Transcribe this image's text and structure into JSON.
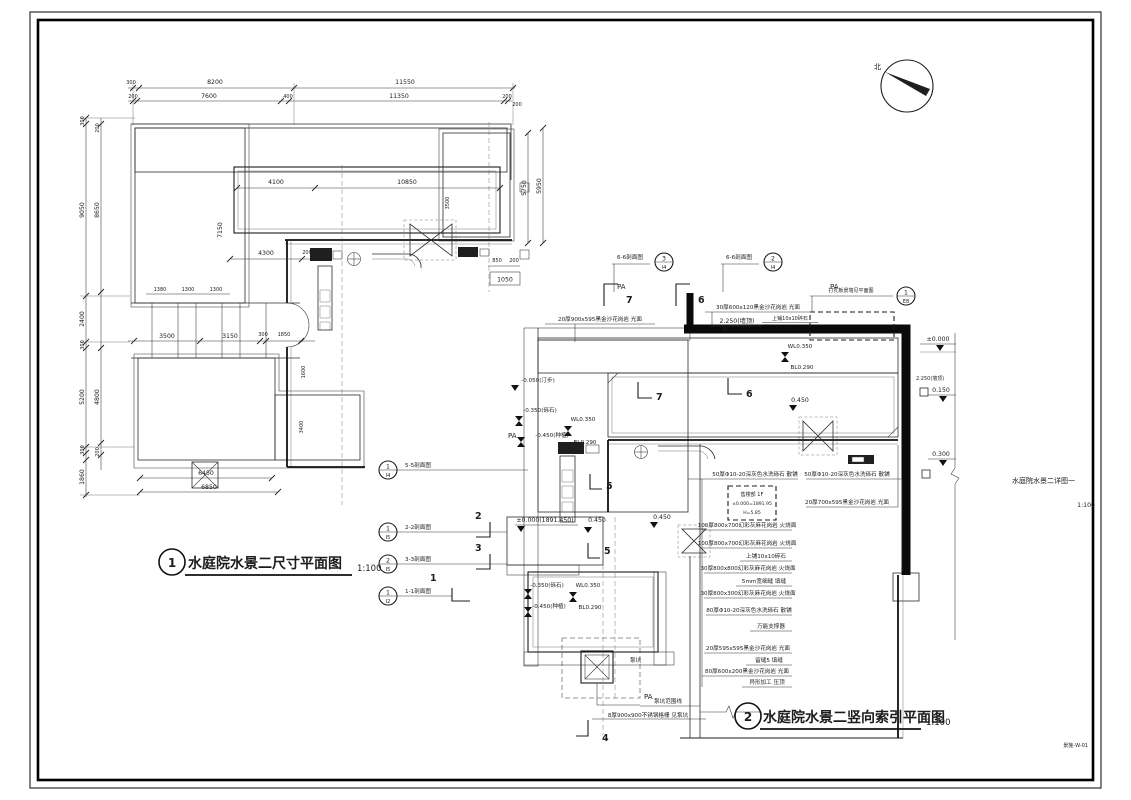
{
  "page": {
    "north": "北",
    "side_title": "水庭院水景二详图一",
    "side_scale": "1:100",
    "sheet_no": "景施-W-01"
  },
  "plan1": {
    "number": "1",
    "title": "水庭院水景二尺寸平面图",
    "scale": "1:100",
    "dims": {
      "t1a": "300",
      "t1b": "8200",
      "t1c": "11550",
      "t2a": "200",
      "t2b": "7600",
      "t2c": "400",
      "t2d": "11350",
      "t2e": "200",
      "l1a": "300",
      "l1b": "9050",
      "l1c": "2400",
      "l1d": "300",
      "l1e": "5200",
      "l1f": "300",
      "l1g": "1860",
      "l2a": "200",
      "l2b": "8650",
      "l2c": "4800",
      "l2d": "200",
      "r1": "5950",
      "r2": "5750",
      "r3": "850",
      "r4": "200",
      "r5": "1050",
      "r6": "200",
      "p1": "4100",
      "p2": "10850",
      "p3": "3500",
      "p4": "7150",
      "m1": "4300",
      "m2": "200",
      "m3": "3500",
      "m4": "3150",
      "m5": "300",
      "m6": "1850",
      "s1": "1380",
      "s2": "1300",
      "s3": "1300",
      "b1": "6450",
      "b2": "6850",
      "v1": "1600",
      "v2": "3400"
    }
  },
  "plan2": {
    "number": "2",
    "title": "水庭院水景二竖向索引平面图",
    "scale": "1:100",
    "pa": "PA",
    "bubbles": {
      "s55": {
        "num": "1",
        "sheet": "I4",
        "label": "5-5剖面图"
      },
      "s22": {
        "num": "1",
        "sheet": "I5",
        "label": "2-2剖面图"
      },
      "s33": {
        "num": "2",
        "sheet": "I5",
        "label": "3-3剖面图"
      },
      "s11": {
        "num": "1",
        "sheet": "I2",
        "label": "1-1剖面图"
      },
      "s66a": {
        "num": "3",
        "sheet": "I4",
        "label": "6-6剖面图"
      },
      "s66b": {
        "num": "2",
        "sheet": "I4",
        "label": "6-6剖面图"
      },
      "wall": {
        "num": "1",
        "sheet": "E8",
        "label": "打孔板景墙见平面图"
      }
    },
    "cuts": {
      "c7": "7",
      "c6": "6",
      "c5": "5",
      "c4": "4",
      "c2": "2",
      "c3": "3",
      "c1": "1"
    },
    "elev": {
      "wallTop": "2.250(墙顶)",
      "zero": "±0.000",
      "e150": "0.150",
      "e300": "0.300",
      "zeroAbs": "±0.000(1891.450)",
      "e450": "0.450",
      "wl": "WL0.350",
      "bl": "BL0.290",
      "step": "-0.050(汀步)",
      "gravel": "-0.350(砾石)",
      "plant": "-0.450(种植)"
    },
    "notes": {
      "t1": "20厚900x595黑金沙花岗岩 光面",
      "t2": "30厚600x120黑金沙花岗岩 光面",
      "t3": "上铺10x10碎石",
      "r1": "50厚Φ10-20深灰色水洗砾石 散铺",
      "r2": "50厚Φ10-20深灰色水洗砾石 散铺",
      "r3": "20厚700x595黑金沙花岗岩 光面",
      "r4": "100厚800x700幻彩灰麻花岗岩 火烧面",
      "r5": "100厚800x700幻彩灰麻花岗岩 火烧面",
      "r6": "上铺10x10碎石",
      "r7": "30厚800x800幻彩灰麻花岗岩 火烧面",
      "r8": "5mm宽细缝 填缝",
      "r9": "30厚800x300幻彩灰麻花岗岩 火烧面",
      "r10": "80厚Φ10-20深灰色水洗砾石 散铺",
      "r11": "万能支撑器",
      "r12": "20厚595x595黑金沙花岗岩 光面",
      "r13": "留缝5 填缝",
      "r14": "80厚600x200黑金沙花岗岩 光面",
      "r15": "异形加工 压顶"
    },
    "sales": {
      "l1": "售楼部 1F",
      "l2": "±0.000=1891.95",
      "l3": "H=5.85"
    },
    "pump": {
      "label": "泵坑",
      "n1": "泵坑范围线",
      "n2": "8厚900x900不锈钢格栅 见泵坑"
    }
  }
}
